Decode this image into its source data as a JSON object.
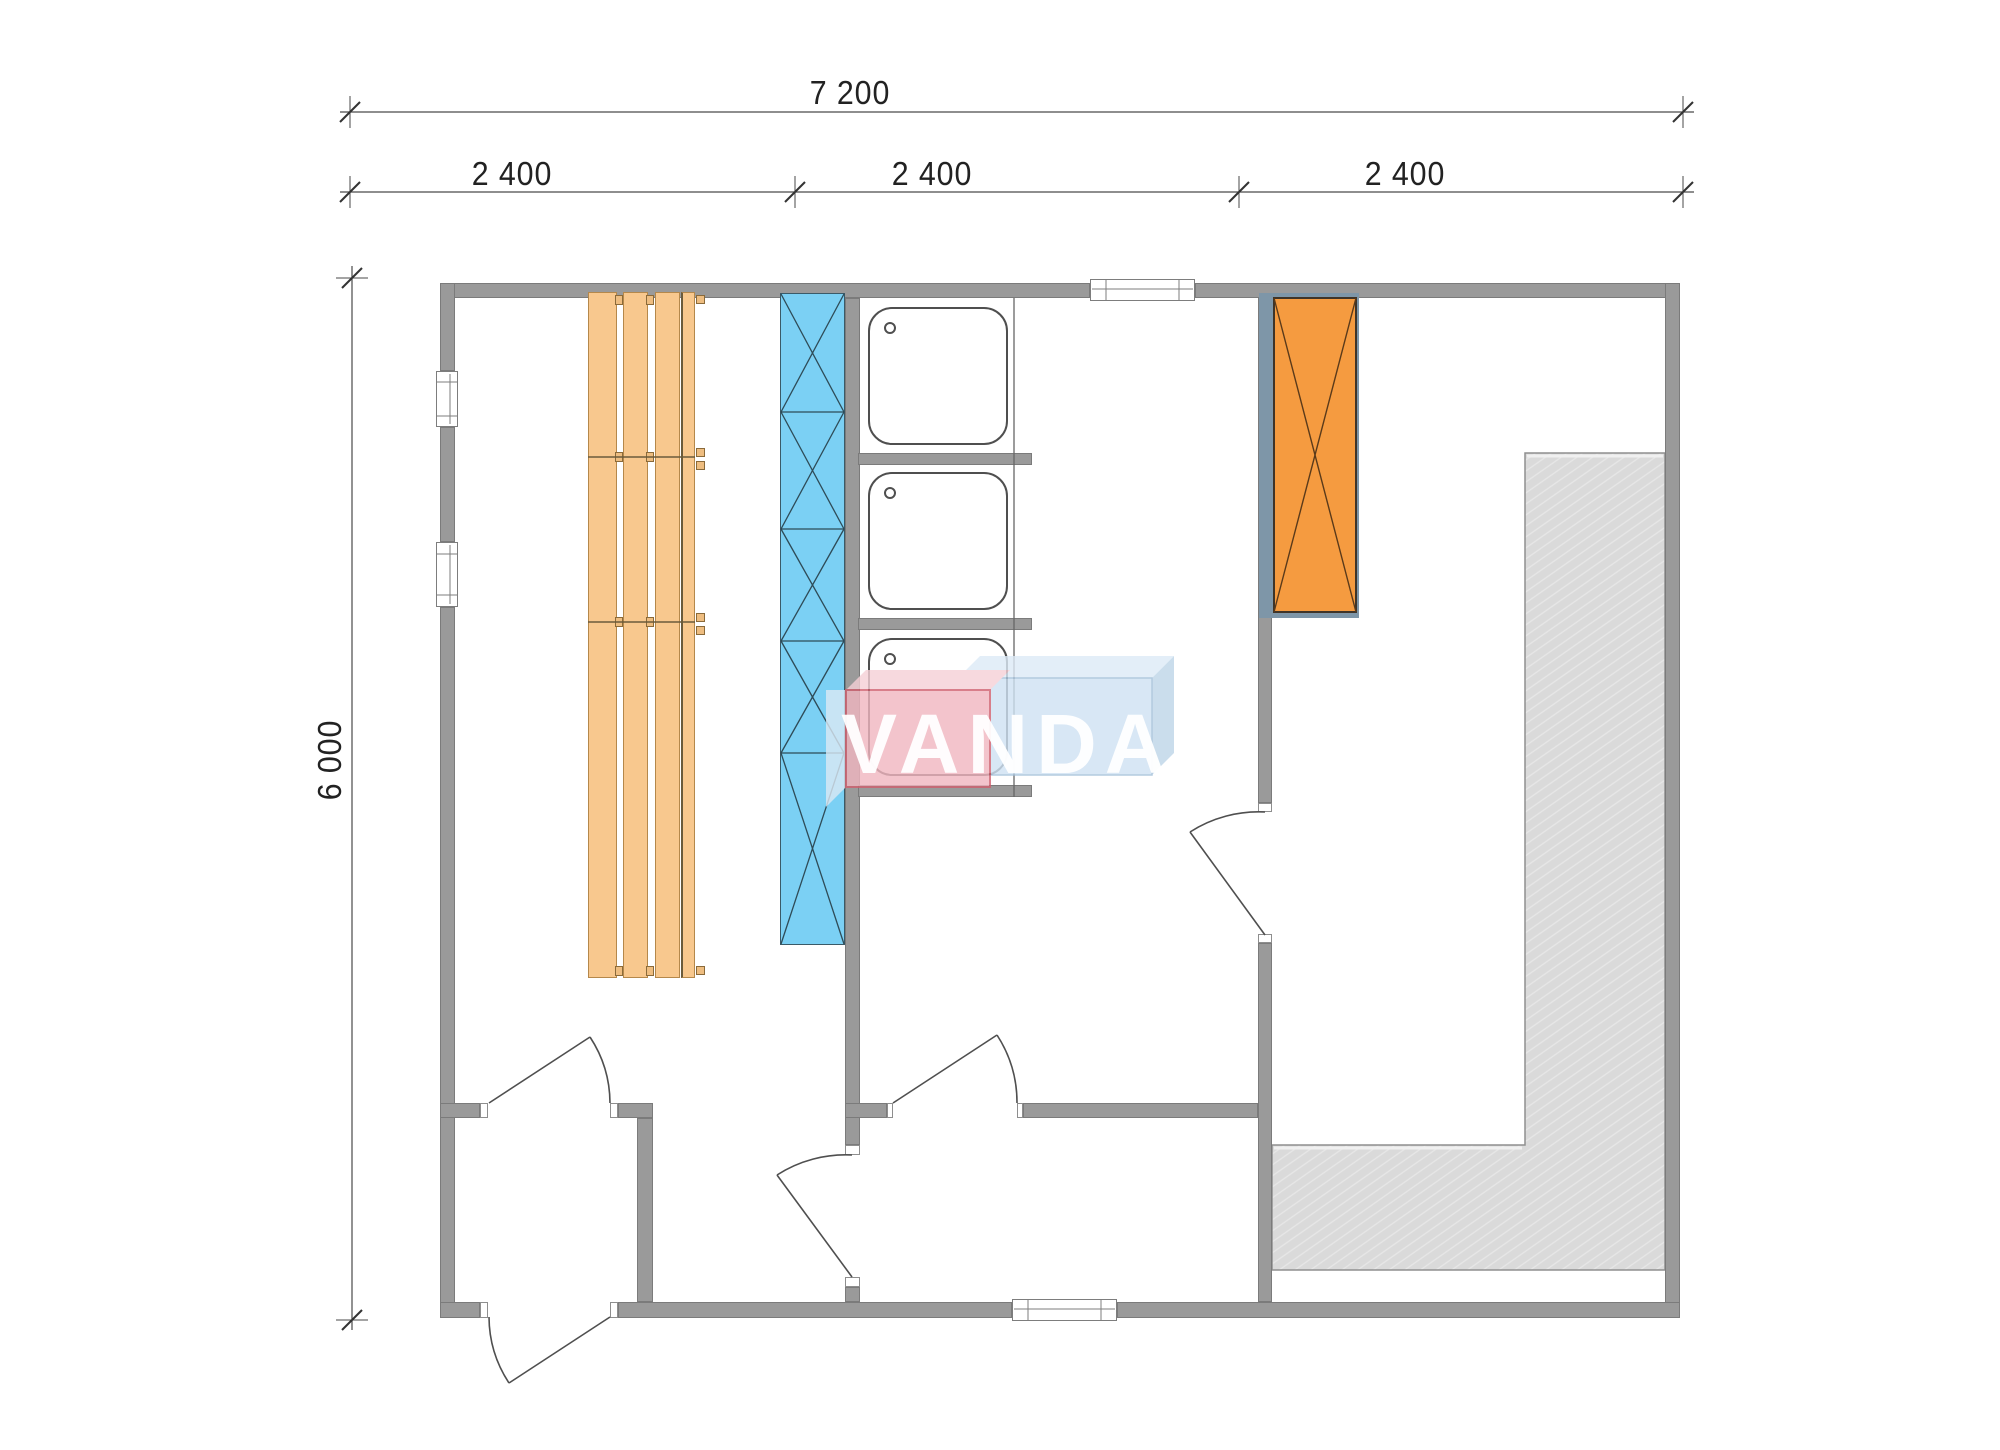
{
  "dimensions": {
    "overall_width_label": "7 200",
    "bay_labels": [
      "2 400",
      "2 400",
      "2 400"
    ],
    "overall_height_label": "6 000"
  },
  "watermark": {
    "text": "VANDA"
  },
  "plan": {
    "type": "sauna-house floor plan, top view",
    "rooms": [
      "sauna room with wooden benches",
      "shower room with three trays",
      "entrance vestibule",
      "rest room with heater and deck"
    ],
    "fixtures": [
      "bench-planks",
      "blue-cross-braced-partition",
      "shower-tray x3",
      "orange-heater-block",
      "gray-deck-L-shaped",
      "doors x5",
      "windows x4"
    ]
  },
  "colors": {
    "wall": "#9a9a9a",
    "wall_edge": "#7b7b7b",
    "bench_wood": "#f8c88e",
    "bench_edge": "#b5884b",
    "glass_partition_blue": "#7bd0f4",
    "heater_orange": "#f59b40",
    "heater_backing_blue_gray": "#7e96a8",
    "deck_gray": "#dadada",
    "dimension_text": "#222222",
    "watermark_pink": "#f1b6c0",
    "watermark_blue": "#cfe2f3",
    "watermark_letters": "#ffffff"
  }
}
